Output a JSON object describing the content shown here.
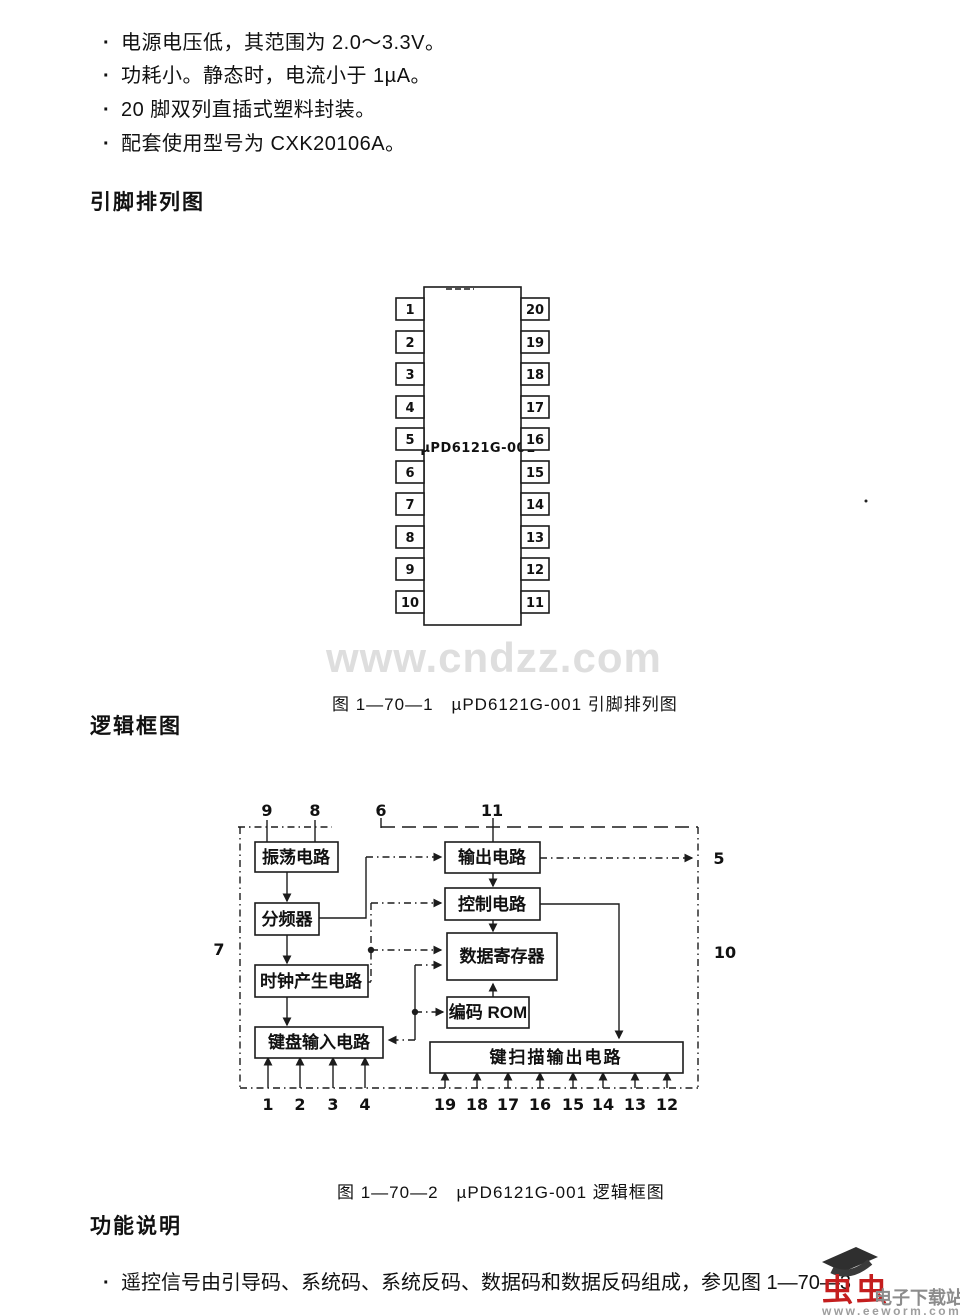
{
  "page": {
    "bullet_char": "·"
  },
  "features": {
    "items": [
      "电源电压低，其范围为 2.0～3.3V。",
      "功耗小。静态时，电流小于 1µA。",
      "20 脚双列直插式塑料封装。",
      "配套使用型号为 CXK20106A。"
    ]
  },
  "pin_section": {
    "title": "引脚排列图",
    "chip_label": "µPD6121G-001",
    "left_pins": [
      "1",
      "2",
      "3",
      "4",
      "5",
      "6",
      "7",
      "8",
      "9",
      "10"
    ],
    "right_pins": [
      "20",
      "19",
      "18",
      "17",
      "16",
      "15",
      "14",
      "13",
      "12",
      "11"
    ],
    "caption": "图 1—70—1　µPD6121G-001 引脚排列图"
  },
  "watermark": {
    "text": "www.cndzz.com"
  },
  "logic_section": {
    "title": "逻辑框图",
    "caption": "图 1—70—2　µPD6121G-001 逻辑框图",
    "blocks": {
      "oscillator": "振荡电路",
      "divider": "分频器",
      "clock": "时钟产生电路",
      "keyboard": "键盘输入电路",
      "output": "输出电路",
      "control": "控制电路",
      "data_register": "数据寄存器",
      "rom": "编码 ROM",
      "keyscan": "键扫描输出电路"
    },
    "pins": {
      "top": [
        "9",
        "8",
        "6",
        "11"
      ],
      "left": "7",
      "right_upper": "5",
      "right_lower": "10",
      "bottom_left": [
        "1",
        "2",
        "3",
        "4"
      ],
      "bottom_right": [
        "19",
        "18",
        "17",
        "16",
        "15",
        "14",
        "13",
        "12"
      ]
    }
  },
  "function_section": {
    "title": "功能说明",
    "item": "遥控信号由引导码、系统码、系统反码、数据码和数据反码组成，参见图 1—70—3"
  },
  "logo": {
    "brand": "虫虫",
    "label": "电子下载站",
    "url": "www.eeworm.com",
    "brand_color": "#c41e1e",
    "label_color": "#8c8c8c"
  }
}
